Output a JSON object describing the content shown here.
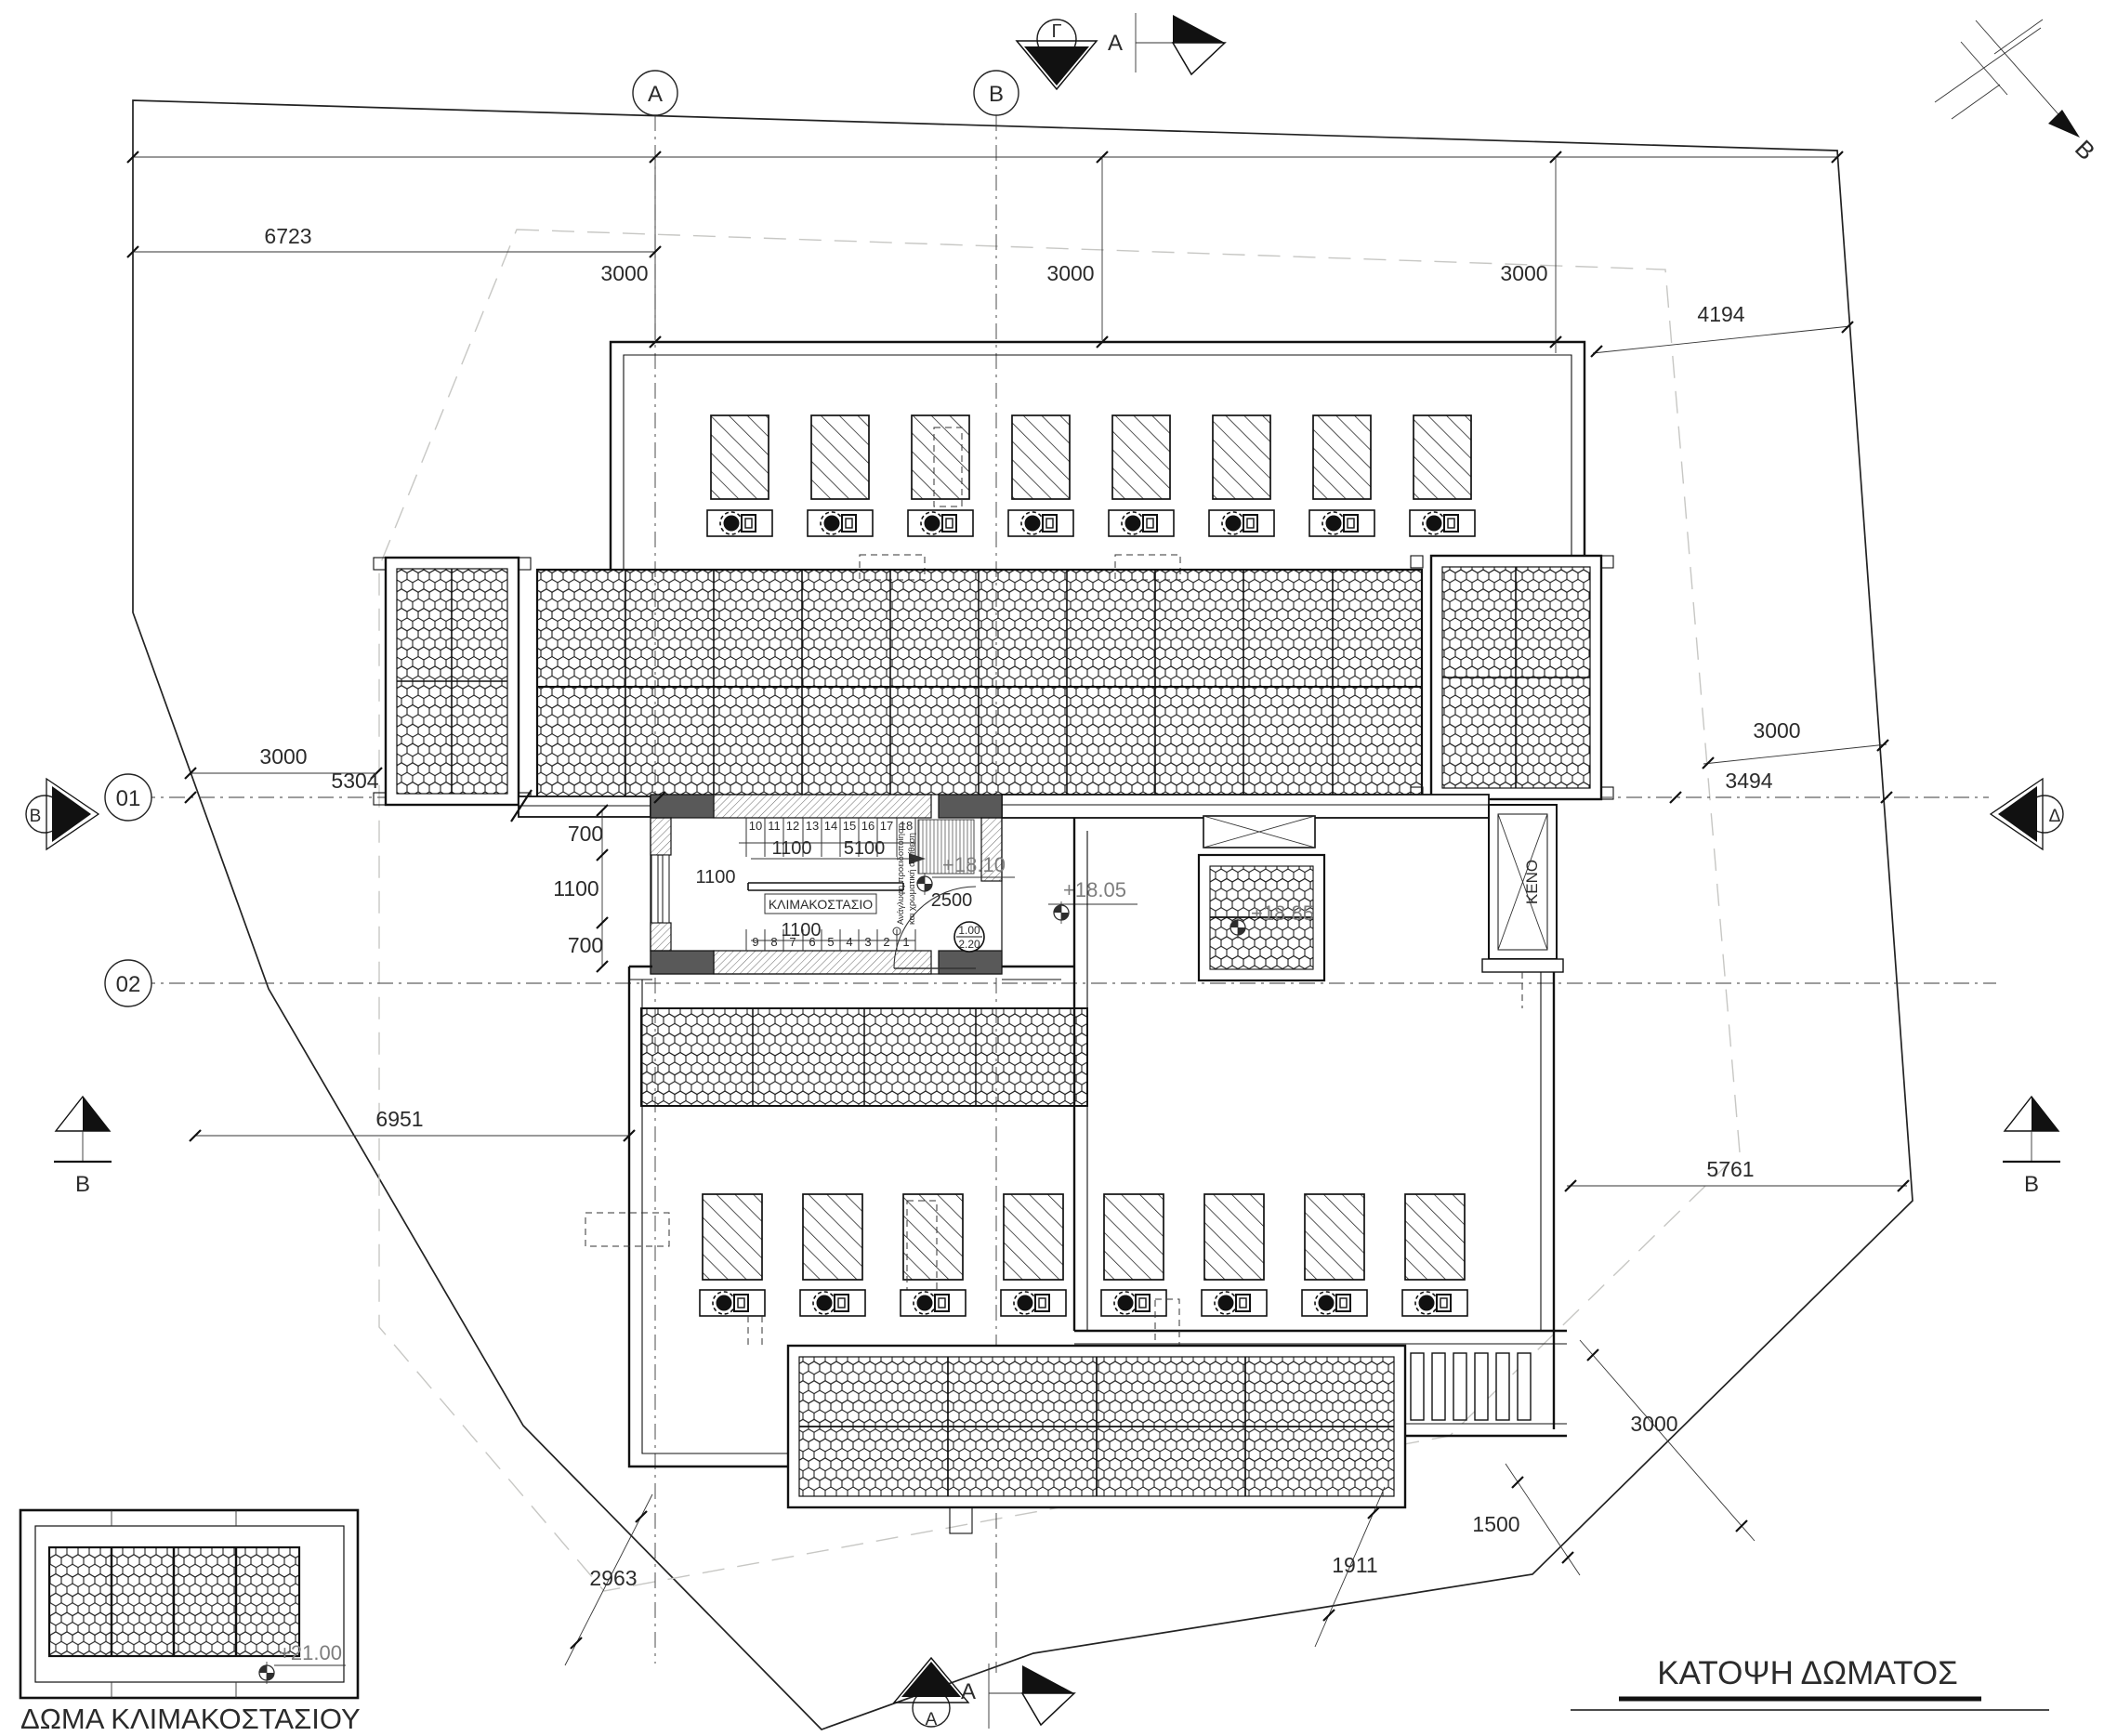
{
  "title": "ΚΑΤΟΨΗ ΔΩΜΑΤΟΣ",
  "inset": {
    "title": "ΔΩΜΑ ΚΛΙΜΑΚΟΣΤΑΣΙΟΥ",
    "level": "+21.00"
  },
  "north": {
    "label": "Β"
  },
  "grid": {
    "a": "A",
    "b": "B",
    "r1": "01",
    "r2": "02"
  },
  "sections": {
    "gamma": "Γ",
    "a_top": "A",
    "a_bottom_cut": "A",
    "a_bottom_circle": "A",
    "b_left": "B",
    "b_bottom_left": "B",
    "b_bottom_right": "B",
    "delta_right": "Δ"
  },
  "levels": {
    "p1805": "+18.05",
    "p1810": "+18.10",
    "p1885": "+18.85"
  },
  "stairs": {
    "label": "ΚΛΙΜΑΚΟΣΤΑΣΙΟ",
    "keno": "ΚΕΝΟ",
    "door_w": "1.00",
    "door_h": "2.20",
    "note1": "Ανάγλυφη προειδοποίηση",
    "note2": "και χρωματική αντίθεση",
    "upper": [
      "10",
      "11",
      "12",
      "13",
      "14",
      "15",
      "16",
      "17",
      "18"
    ],
    "lower": [
      "9",
      "8",
      "7",
      "6",
      "5",
      "4",
      "3",
      "2",
      "1"
    ],
    "d1100a": "1100",
    "d5100": "5100",
    "d1100b": "1100",
    "d1100c": "1100",
    "d2500": "2500"
  },
  "dims": {
    "d3000": "3000",
    "d6723": "6723",
    "d4194": "4194",
    "d5304": "5304",
    "d3494": "3494",
    "d700a": "700",
    "d1100w": "1100",
    "d700b": "700",
    "d6951": "6951",
    "d5761": "5761",
    "d1500": "1500",
    "d1911": "1911",
    "d2963": "2963"
  }
}
